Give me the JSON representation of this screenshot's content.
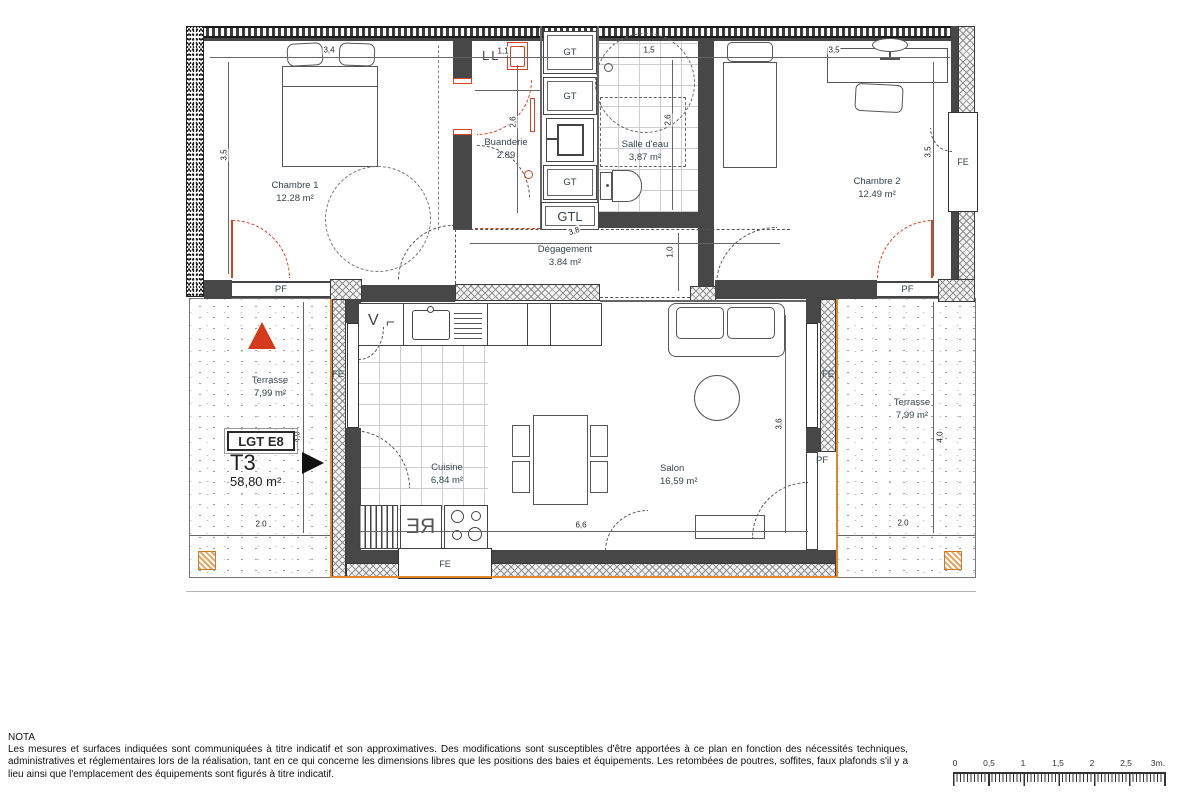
{
  "plan": {
    "unit": {
      "badge": "LGT E8",
      "type": "T3",
      "area": "58,80 m²"
    },
    "rooms": {
      "chambre1": {
        "name": "Chambre 1",
        "area": "12.28 m²"
      },
      "chambre2": {
        "name": "Chambre 2",
        "area": "12.49 m²"
      },
      "buanderie": {
        "name": "Buanderie",
        "area": "2.89"
      },
      "salle_eau": {
        "name": "Salle d'eau",
        "area": "3,87 m²"
      },
      "degagement": {
        "name": "Dégagement",
        "area": "3.84 m²"
      },
      "cuisine": {
        "name": "Cuisine",
        "area": "6,84 m²"
      },
      "salon": {
        "name": "Salon",
        "area": "16,59 m²"
      },
      "terrasse_left": {
        "name": "Terrasse",
        "area": "7,99 m²"
      },
      "terrasse_right": {
        "name": "Terrasse",
        "area": "7,99 m²"
      }
    },
    "openings": {
      "fe": "FE",
      "pf": "PF"
    },
    "ducts": {
      "gt": "GT",
      "gtl": "GTL"
    },
    "appliances": {
      "re": "RE",
      "hood_v": "V",
      "hood_corner": "⌐",
      "washer": "LL"
    },
    "dims": {
      "top_ch1": "3,4",
      "top_bua": "1,1",
      "top_sde": "1,5",
      "top_ch2": "3,5",
      "ch1_left": "3,5",
      "bua_mid": "2,6",
      "sde_right": "2,6",
      "ch2_right": "3,5",
      "deg_width": "3,8",
      "deg_height": "1,0",
      "salon_height": "3,6",
      "living_width": "6,6",
      "ter_left_h": "4,0",
      "ter_right_h": "4,0",
      "ter_left_w": "2.0",
      "ter_right_w": "2.0"
    },
    "colors": {
      "door_red": "#d6431f",
      "trim_orange": "#e0862f",
      "wall_dark": "#474747",
      "north_red": "#d63a1c"
    }
  },
  "nota": {
    "title": "NOTA",
    "body": "Les mesures et surfaces indiquées sont communiquées à titre indicatif et son approximatives. Des modifications sont susceptibles d'être apportées à ce plan en fonction des nécessités techniques, administratives et réglementaires lors de la réalisation, tant en ce qui concerne les dimensions libres que les positions des baies et équipements. Les retombées de poutres, soffites, faux plafonds s'il y a lieu ainsi que l'emplacement des équipements sont figurés à titre indicatif."
  },
  "scalebar": {
    "t0": "0",
    "t1": "0,5",
    "t2": "1",
    "t3": "1,5",
    "t4": "2",
    "t5": "2,5",
    "t6": "3m."
  }
}
